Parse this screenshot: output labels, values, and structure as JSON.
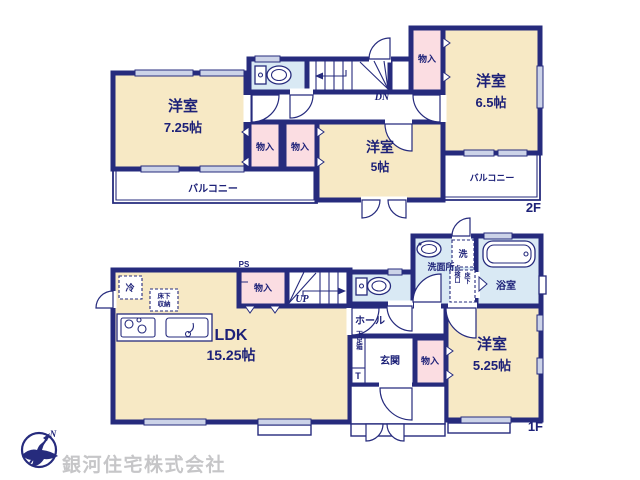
{
  "floors": {
    "f2": {
      "tag": "2F",
      "room_a": {
        "name": "洋室",
        "size": "7.25帖"
      },
      "room_b": {
        "name": "洋室",
        "size": "6.5帖"
      },
      "room_c": {
        "name": "洋室",
        "size": "5帖"
      },
      "closet_left": "物入",
      "closet_center": "物入",
      "closet_right": "物入",
      "balcony_left": "バルコニー",
      "balcony_right": "バルコニー",
      "stairs": "DN"
    },
    "f1": {
      "tag": "1F",
      "ldk": {
        "name": "LDK",
        "size": "15.25帖"
      },
      "room_d": {
        "name": "洋室",
        "size": "5.25帖"
      },
      "fridge": "冷",
      "underfloor_storage_line1": "床下",
      "underfloor_storage_line2": "収納",
      "pipe_space": "PS",
      "closet_top": "物入",
      "closet_entry": "物入",
      "stairs": "UP",
      "hall": "ホール",
      "entry": "玄関",
      "shoe_box": "下足箱",
      "shoe_box_t": "T",
      "washroom": "洗面所",
      "washer": "洗",
      "inspection_hatch": "点検口",
      "inspection_floor": "床下",
      "bathroom": "浴室"
    }
  },
  "footer": {
    "company": "銀河住宅株式会社",
    "compass": "N"
  },
  "colors": {
    "wall": "#262b7d",
    "room_fill": "#f7e9c5",
    "closet_fill": "#fbdde2",
    "wet_area_fill": "#d9e9f4",
    "window_fill": "#ccd3e8",
    "text": "#1d2178",
    "logo_text": "#c6c6c8"
  }
}
